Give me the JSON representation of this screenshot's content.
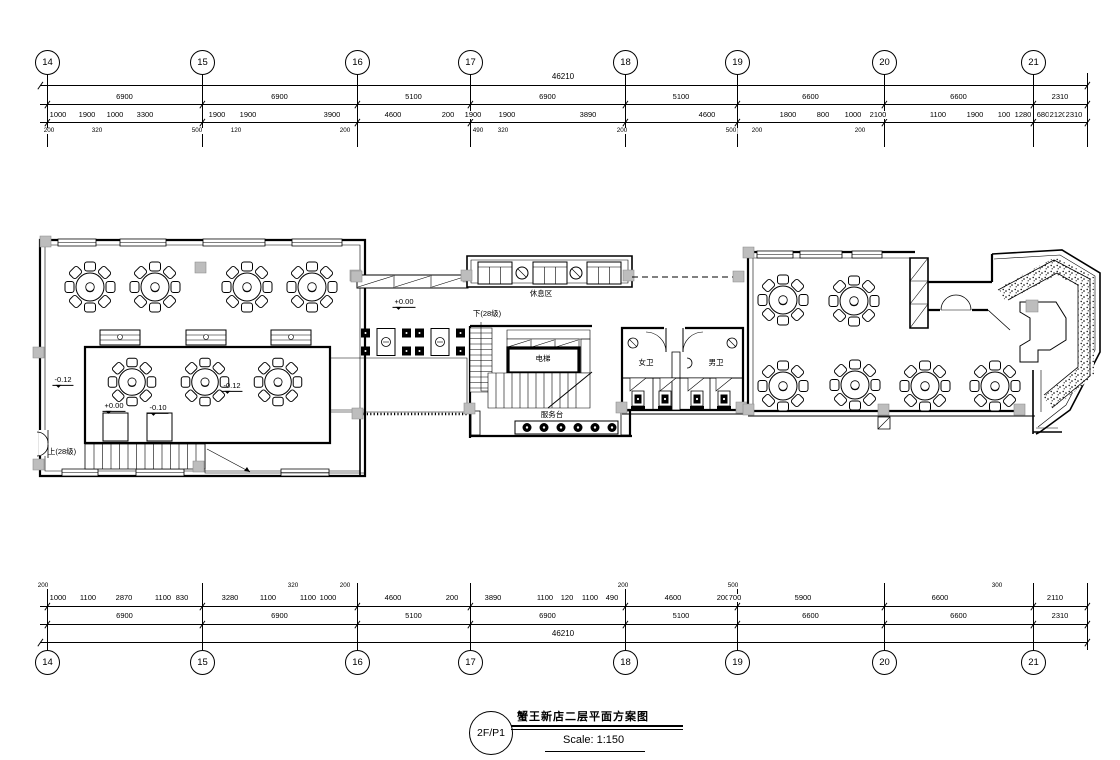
{
  "title_block": {
    "tag": "2F/P1",
    "title": "蟹王新店二层平面方案图",
    "scale_label": "Scale: 1:150"
  },
  "grid": {
    "bubbles": [
      "14",
      "15",
      "16",
      "17",
      "18",
      "19",
      "20",
      "21"
    ],
    "bubble_x": [
      47,
      202,
      357,
      470,
      625,
      737,
      884,
      1033
    ],
    "span_bounds": [
      47,
      202,
      357,
      470,
      625,
      737,
      884,
      1033,
      1087
    ],
    "top": {
      "total": "46210",
      "total_x": 563,
      "majors": [
        "6900",
        "6900",
        "5100",
        "6900",
        "5100",
        "6600",
        "6600",
        "2310"
      ],
      "minors": [
        [
          "1000",
          58
        ],
        [
          "1900",
          87
        ],
        [
          "1000",
          115
        ],
        [
          "3300",
          145
        ],
        [
          "1900",
          217
        ],
        [
          "1900",
          248
        ],
        [
          "3900",
          332
        ],
        [
          "4600",
          393
        ],
        [
          "200",
          448
        ],
        [
          "1900",
          473
        ],
        [
          "1900",
          507
        ],
        [
          "3890",
          588
        ],
        [
          "4600",
          707
        ],
        [
          "1800",
          788
        ],
        [
          "800",
          823
        ],
        [
          "1000",
          853
        ],
        [
          "2100",
          878
        ],
        [
          "1100",
          938
        ],
        [
          "1900",
          975
        ],
        [
          "100",
          1004
        ],
        [
          "1280",
          1023
        ],
        [
          "680",
          1043
        ],
        [
          "2120",
          1058
        ],
        [
          "2310",
          1074
        ]
      ],
      "offsets": [
        [
          "200",
          49
        ],
        [
          "320",
          97
        ],
        [
          "500",
          197
        ],
        [
          "120",
          236
        ],
        [
          "200",
          345
        ],
        [
          "490",
          478
        ],
        [
          "320",
          503
        ],
        [
          "200",
          622
        ],
        [
          "500",
          731
        ],
        [
          "200",
          757
        ],
        [
          "200",
          860
        ]
      ]
    },
    "bottom": {
      "total": "46210",
      "total_x": 563,
      "majors": [
        "6900",
        "6900",
        "5100",
        "6900",
        "5100",
        "6600",
        "6600",
        "2310"
      ],
      "minors": [
        [
          "1000",
          58
        ],
        [
          "1100",
          88
        ],
        [
          "2870",
          124
        ],
        [
          "1100",
          163
        ],
        [
          "830",
          182
        ],
        [
          "3280",
          230
        ],
        [
          "1100",
          268
        ],
        [
          "1100",
          308
        ],
        [
          "1000",
          328
        ],
        [
          "4600",
          393
        ],
        [
          "200",
          452
        ],
        [
          "3890",
          493
        ],
        [
          "1100",
          545
        ],
        [
          "120",
          567
        ],
        [
          "1100",
          590
        ],
        [
          "490",
          612
        ],
        [
          "4600",
          673
        ],
        [
          "200",
          723
        ],
        [
          "700",
          735
        ],
        [
          "5900",
          803
        ],
        [
          "6600",
          940
        ],
        [
          "2110",
          1055
        ]
      ],
      "offsets": [
        [
          "200",
          43
        ],
        [
          "320",
          293
        ],
        [
          "200",
          345
        ],
        [
          "200",
          623
        ],
        [
          "500",
          733
        ],
        [
          "300",
          997
        ]
      ]
    }
  },
  "plan_labels": [
    {
      "text": "-0.12",
      "x": 63,
      "y": 381,
      "cls": "lvl"
    },
    {
      "text": "-0.12",
      "x": 232,
      "y": 387,
      "cls": "lvl"
    },
    {
      "text": "+0.00",
      "x": 404,
      "y": 303,
      "cls": "lvl"
    },
    {
      "text": "+0.00",
      "x": 114,
      "y": 407,
      "cls": "lvl"
    },
    {
      "text": "-0.10",
      "x": 158,
      "y": 409,
      "cls": "lvl"
    },
    {
      "text": "上(28级)",
      "x": 62,
      "y": 452,
      "cls": "room"
    },
    {
      "text": "下(28级)",
      "x": 487,
      "y": 314,
      "cls": "room"
    },
    {
      "text": "休息区",
      "x": 541,
      "y": 294,
      "cls": "room"
    },
    {
      "text": "电梯",
      "x": 543,
      "y": 359,
      "cls": "room"
    },
    {
      "text": "服务台",
      "x": 552,
      "y": 415,
      "cls": "room"
    },
    {
      "text": "女卫",
      "x": 646,
      "y": 363,
      "cls": "room"
    },
    {
      "text": "男卫",
      "x": 716,
      "y": 363,
      "cls": "room"
    }
  ]
}
